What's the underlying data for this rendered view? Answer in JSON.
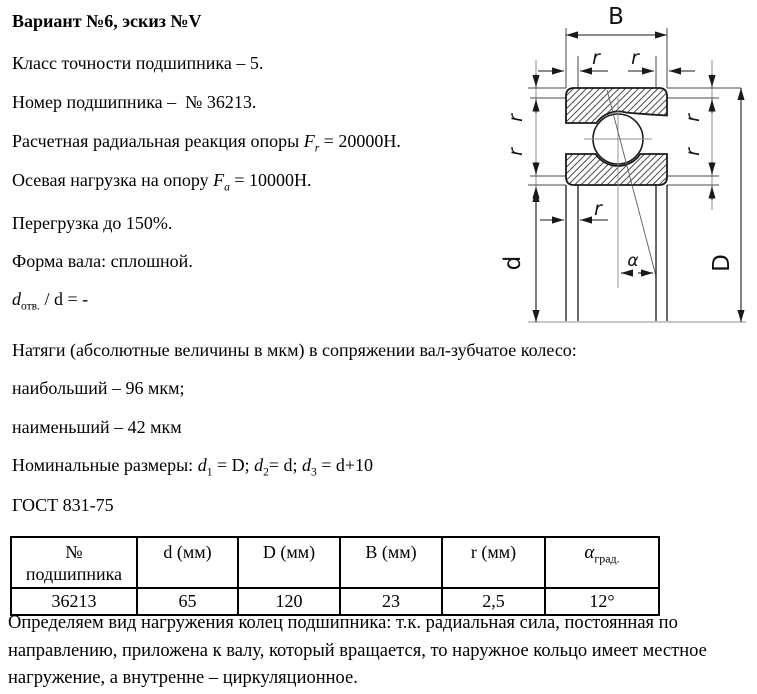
{
  "intro": {
    "title": "Вариант №6, эскиз №V",
    "precision": "Класс точности подшипника – 5.",
    "number": "Номер подшипника –  № 36213.",
    "radial": {
      "prefix": "Расчетная радиальная реакция опоры ",
      "symbol": "F",
      "sub": "r",
      "rest": " = 20000Н."
    },
    "axial": {
      "prefix": "Осевая нагрузка на опору ",
      "symbol": "F",
      "sub": "a",
      "rest": " = 10000Н."
    },
    "overload": "Перегрузка до 150%.",
    "shaft": "Форма вала: сплошной.",
    "bore_ratio": {
      "symbol": "d",
      "sub": "отв.",
      "rest": " / d = -"
    },
    "interference_title": "Натяги (абсолютные величины в мкм) в сопряжении вал-зубчатое колесо:",
    "interference_max": "наибольший – 96 мкм;",
    "interference_min": "наименьший – 42 мкм",
    "nominal": {
      "prefix": "Номинальные размеры: ",
      "d": "d",
      "s1": "1",
      "e1": " = D; ",
      "s2": "2",
      "e2": "= d; ",
      "s3": "3",
      "e3": " = d+10"
    },
    "gost": "ГОСТ 831-75"
  },
  "drawing": {
    "width_label": "B",
    "chamfer_label": "r",
    "bore_label": "d",
    "outer_label": "D",
    "angle_label": "α"
  },
  "table": {
    "col1_line1": "№",
    "col1_line2": "подшипника",
    "col_d": "d (мм)",
    "col_D": "D (мм)",
    "col_B": "B (мм)",
    "col_r": "r (мм)",
    "col_alpha_symbol": "α",
    "col_alpha_sub": "град.",
    "row": {
      "number": "36213",
      "d": "65",
      "D": "120",
      "B": "23",
      "r": "2,5",
      "alpha": "12°"
    }
  },
  "conclusion": "Определяем вид нагружения колец подшипника: т.к. радиальная сила, постоянная по направлению, приложена к валу, который вращается, то наружное кольцо имеет местное нагружение, а внутренне – циркуляционное."
}
